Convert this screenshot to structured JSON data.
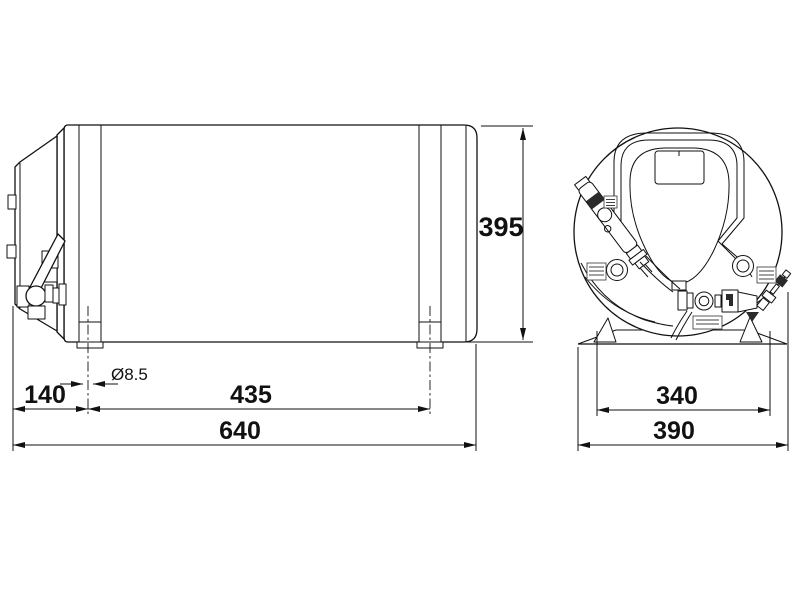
{
  "colors": {
    "background": "#ffffff",
    "line": "#111111"
  },
  "side_view": {
    "dims": {
      "height": "395",
      "hole_diameter": "Ø8.5",
      "offset": "140",
      "foot_spacing": "435",
      "overall_length": "640"
    }
  },
  "end_view": {
    "dims": {
      "base_hole_spacing": "340",
      "overall_width": "390"
    }
  }
}
